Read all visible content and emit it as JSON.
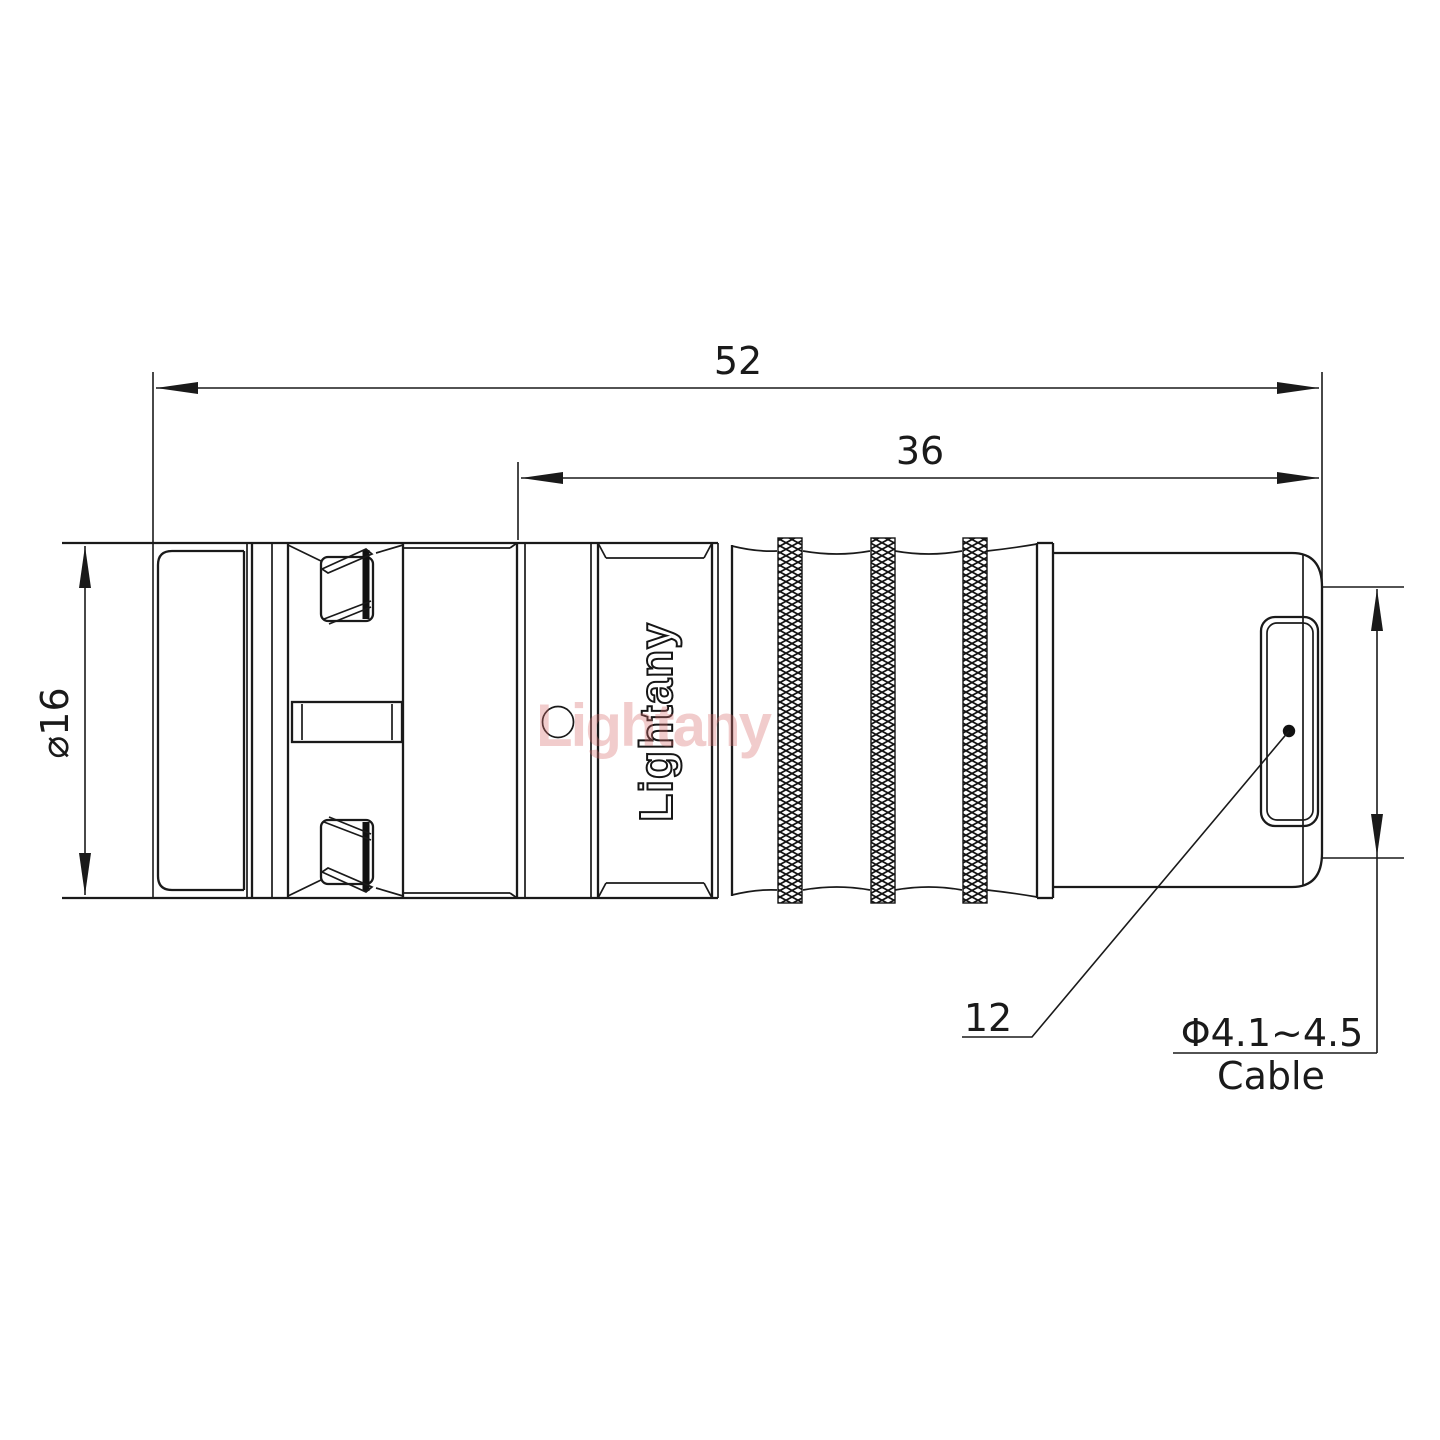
{
  "labels": {
    "overall_length": "52",
    "mid_length": "36",
    "diameter": "⌀16",
    "rear_length": "12",
    "cable_diameter": "Φ4.1~4.5",
    "cable": "Cable"
  },
  "branding": {
    "watermark": "Lightany",
    "engraving": "Lightany"
  },
  "colors": {
    "line": "#1a1a1a",
    "watermark": "#d96c6c",
    "dot": "#111111"
  }
}
